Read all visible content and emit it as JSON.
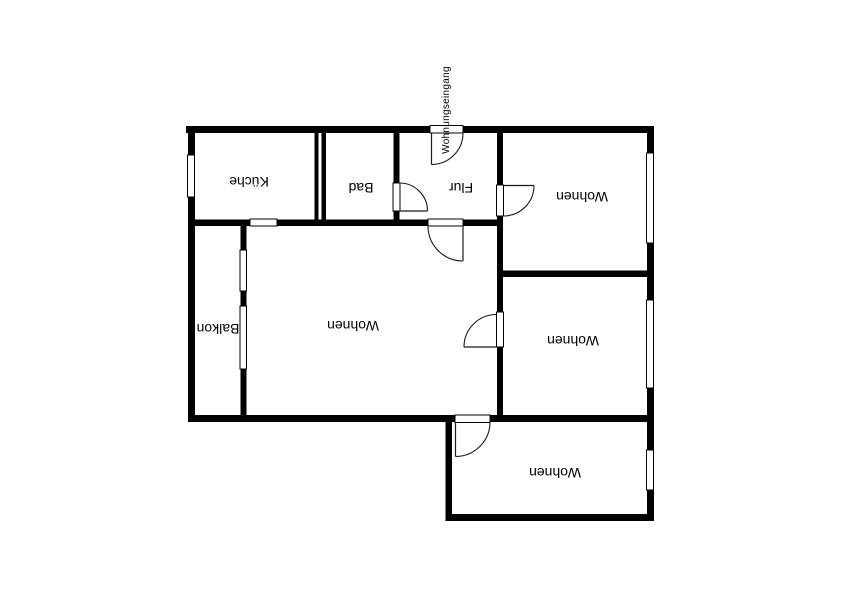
{
  "colors": {
    "wall": "#000000",
    "background": "#ffffff",
    "line": "#1a1a1a"
  },
  "entrance": {
    "label": "Wohnungseingang"
  },
  "rooms": {
    "kueche": {
      "label": "Küche"
    },
    "bad": {
      "label": "Bad"
    },
    "flur": {
      "label": "Flur"
    },
    "wohnen_nordost": {
      "label": "Wohnen"
    },
    "wohnen_gross": {
      "label": "Wohnen"
    },
    "wohnen_ost": {
      "label": "Wohnen"
    },
    "wohnen_sued": {
      "label": "Wohnen"
    },
    "balkon": {
      "label": "Balkon"
    }
  }
}
